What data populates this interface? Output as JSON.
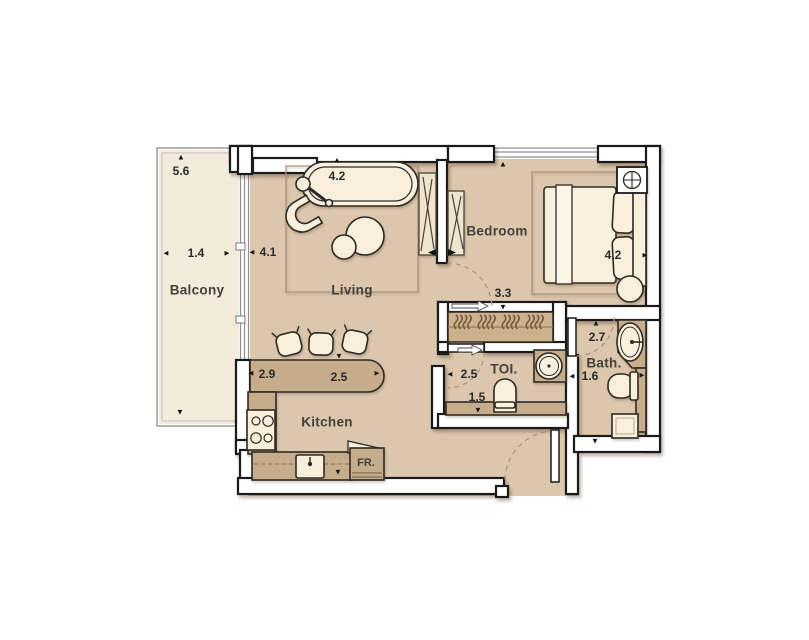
{
  "plan": {
    "rooms": {
      "balcony": "Balcony",
      "living": "Living",
      "bedroom": "Bedroom",
      "kitchen": "Kitchen",
      "toilet": "TOI.",
      "bath": "Bath."
    },
    "appliances": {
      "fridge": "FR."
    },
    "dimensions": {
      "balcony_length": "5.6",
      "balcony_width": "1.4",
      "living_width": "4.1",
      "living_length": "4.2",
      "bedroom_length": "4.2",
      "corridor_width": "3.3",
      "bath_length": "2.7",
      "bath_width": "1.6",
      "toilet_width": "2.5",
      "toilet_length": "1.5",
      "kitchen_width": "2.9",
      "kitchen_bar_length": "2.5"
    },
    "arrows": {
      "up": "▲",
      "down": "▼",
      "left": "◄",
      "right": "►"
    },
    "colors": {
      "floor": "#dcc7ae",
      "balcony_floor": "#f3ebdb",
      "counter": "#c7ac8c",
      "closet": "#cdb18d",
      "furniture": "#f8f0dd",
      "wall": "#ffffff",
      "outline": "#1a1a1a",
      "accent_dash": "#a79884"
    }
  }
}
